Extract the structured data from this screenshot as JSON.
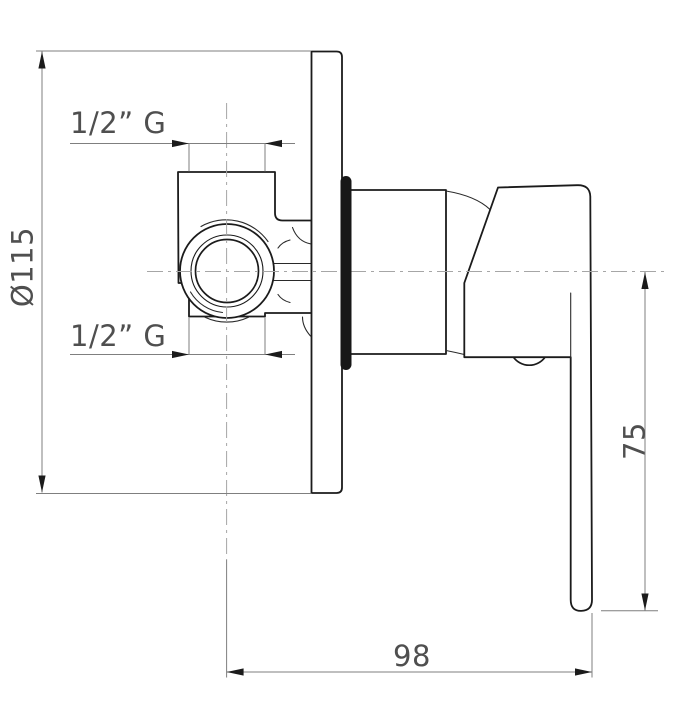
{
  "page": {
    "width": 675,
    "height": 709,
    "background": "#ffffff"
  },
  "diagram": {
    "type": "technical-drawing",
    "subject": "Concealed single-lever shower mixer, side view",
    "colors": {
      "outline": "#1b1b1b",
      "dimension_line": "#7f7f7f",
      "centerline": "#a6a6a6",
      "dimension_text": "#4f4f4f",
      "gasket_fill": "#171717",
      "background": "#ffffff"
    },
    "dimensions": [
      {
        "id": "plate-diameter",
        "label": "Ø115",
        "orientation": "vertical"
      },
      {
        "id": "inlet-top",
        "label": "1/2” G",
        "orientation": "horizontal"
      },
      {
        "id": "inlet-bottom",
        "label": "1/2” G",
        "orientation": "horizontal"
      },
      {
        "id": "lever-length",
        "label": "75",
        "orientation": "vertical"
      },
      {
        "id": "depth",
        "label": "98",
        "orientation": "horizontal"
      }
    ]
  }
}
